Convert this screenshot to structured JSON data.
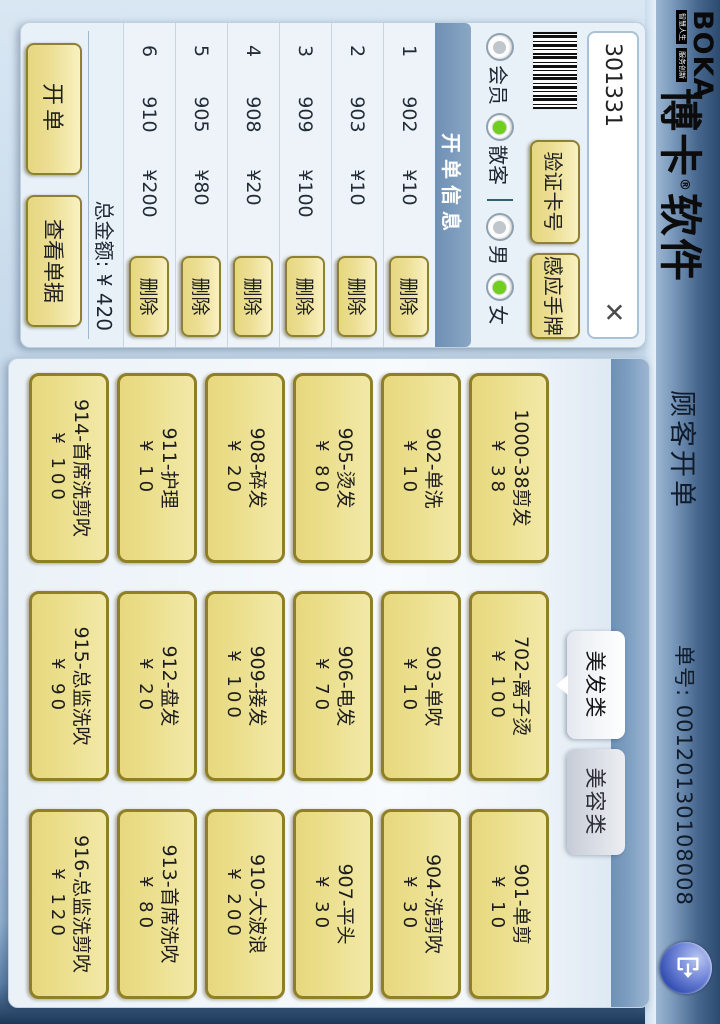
{
  "title_bar": {
    "logo_text": "BOKA",
    "logo_tagline_left": "智慧人生",
    "logo_tagline_right": "服务创新",
    "brand_prefix": "博卡",
    "brand_reg_mark": "®",
    "brand_suffix": "软件",
    "page_title": "顾客开单",
    "order_no_label": "单号:",
    "order_no_value": "00120130108008",
    "exit_icon": "exit-door-icon"
  },
  "billing_panel": {
    "card_input": {
      "value": "301331",
      "clear_glyph": "✕"
    },
    "barcode_icon": "barcode-icon",
    "verify_button": "验证卡号",
    "sense_button": "感应手牌",
    "radios": [
      {
        "label": "会员",
        "checked": false
      },
      {
        "label": "散客",
        "checked": true
      },
      {
        "label": "男",
        "checked": false
      },
      {
        "label": "女",
        "checked": true
      }
    ],
    "header": "开单信息",
    "delete_button_label": "删除",
    "items": [
      {
        "no": "1",
        "code": "902",
        "price": "¥10"
      },
      {
        "no": "2",
        "code": "903",
        "price": "¥10"
      },
      {
        "no": "3",
        "code": "909",
        "price": "¥100"
      },
      {
        "no": "4",
        "code": "908",
        "price": "¥20"
      },
      {
        "no": "5",
        "code": "905",
        "price": "¥80"
      },
      {
        "no": "6",
        "code": "910",
        "price": "¥200"
      }
    ],
    "total_label": "总金额: ¥ 420",
    "open_bill_button": "开单",
    "view_bills_button": "查看单据"
  },
  "services": {
    "tabs": [
      {
        "label": "美发类",
        "active": true
      },
      {
        "label": "美容类",
        "active": false
      }
    ],
    "buttons": [
      {
        "name": "1000-38剪发",
        "price": "¥ 38"
      },
      {
        "name": "702-离子烫",
        "price": "¥ 100"
      },
      {
        "name": "901-单剪",
        "price": "¥ 10"
      },
      {
        "name": "902-单洗",
        "price": "¥ 10"
      },
      {
        "name": "903-单吹",
        "price": "¥ 10"
      },
      {
        "name": "904-洗剪吹",
        "price": "¥ 30"
      },
      {
        "name": "905-烫发",
        "price": "¥ 80"
      },
      {
        "name": "906-电发",
        "price": "¥ 70"
      },
      {
        "name": "907-平头",
        "price": "¥ 30"
      },
      {
        "name": "908-碎发",
        "price": "¥ 20"
      },
      {
        "name": "909-接发",
        "price": "¥ 100"
      },
      {
        "name": "910-大波浪",
        "price": "¥ 200"
      },
      {
        "name": "911-护理",
        "price": "¥ 10"
      },
      {
        "name": "912-盘发",
        "price": "¥ 20"
      },
      {
        "name": "913-首席洗吹",
        "price": "¥ 80"
      },
      {
        "name": "914-首席洗剪吹",
        "price": "¥ 100"
      },
      {
        "name": "915-总监洗吹",
        "price": "¥ 90"
      },
      {
        "name": "916-总监洗剪吹",
        "price": "¥ 120"
      }
    ]
  }
}
